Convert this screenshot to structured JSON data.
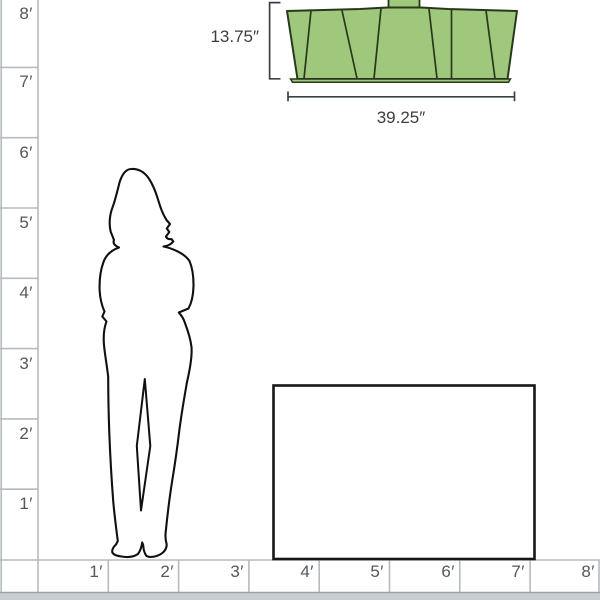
{
  "diagram": {
    "description": "Product scale diagram comparing a ceiling light fixture to a person and a table",
    "background_color": "#ffffff"
  },
  "fixture": {
    "name": "ceiling-light-fixture",
    "height_label": "13.75″",
    "width_label": "39.25″",
    "fill_color": "#a0c87c",
    "outline_color": "#27391a",
    "dimension_line_color": "#3c4043"
  },
  "rulers": {
    "line_color": "#b5bac0",
    "text_color": "#54575b",
    "ground_strip_color": "#c9ced2",
    "vertical": {
      "labels": [
        "8′",
        "7′",
        "6′",
        "5′",
        "4′",
        "3′",
        "2′",
        "1′"
      ]
    },
    "horizontal": {
      "labels": [
        "1′",
        "2′",
        "3′",
        "4′",
        "5′",
        "6′",
        "7′",
        "8′"
      ]
    }
  },
  "figures": {
    "person": "standing-woman-silhouette",
    "table": "table-outline"
  }
}
